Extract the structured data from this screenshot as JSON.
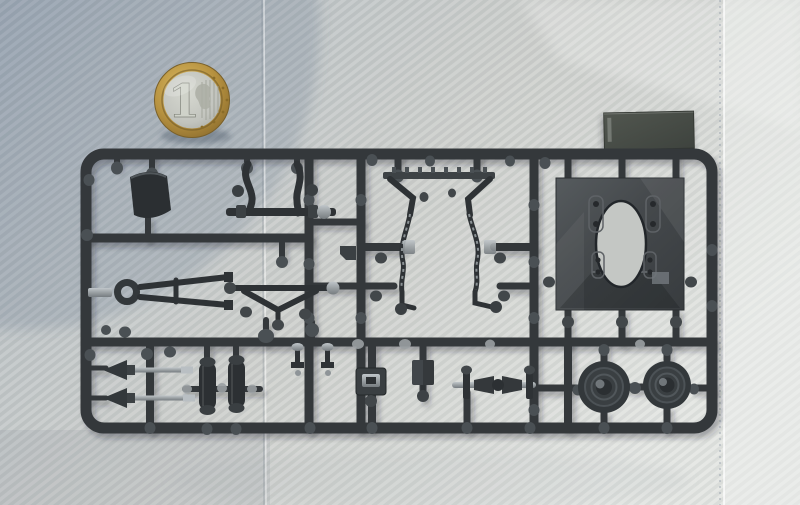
{
  "meta": {
    "domain": "Natural-Image",
    "description": "Photograph of a dark grey injection-moulded model-kit sprue (parts tree) lying on white twill fabric, with a 1 euro coin placed at top left for scale and a loose flat dark plate part at top right."
  },
  "coin": {
    "numeral": "1",
    "type": "1-euro-coin-scale-reference"
  },
  "palette": {
    "sprue": "#34383b",
    "sprue_hl": "#4a5054",
    "part": "#2e3235",
    "metal": "#9aa0a3",
    "fabric_light": "#dadcd9",
    "fabric_shadow": "#a9b2bc",
    "coin_gold": "#b6913f",
    "coin_silver": "#c2c4be",
    "plate": "#474c47"
  },
  "objects": {
    "sprue": "rectangular runner frame with internal rails",
    "parts": [
      "seat-shell",
      "wishbone-axle",
      "suspension-a-arm",
      "v-brace",
      "funnel-and-chain-assembly",
      "floor-panel-with-oval-cutout",
      "loose-dark-plate",
      "drive-shaft-darts",
      "shock-cylinders",
      "buckle-fitting",
      "block-and-ball-fitting",
      "tie-rod-butterfly",
      "wheel-disc-left",
      "wheel-disc-right",
      "small-bolt-fittings"
    ]
  }
}
